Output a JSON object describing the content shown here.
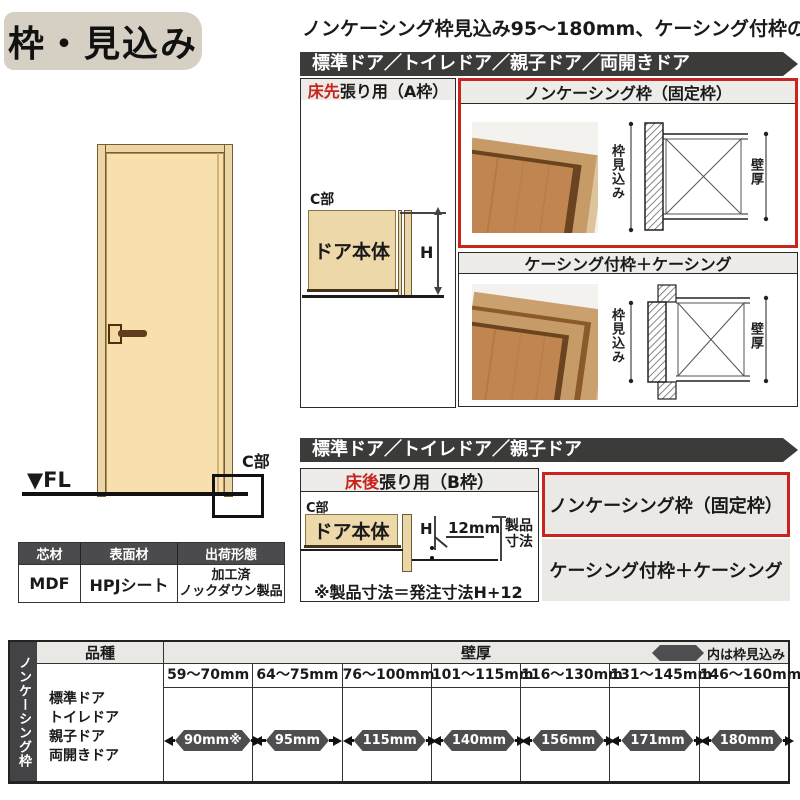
{
  "page": {
    "title": "枠・見込み",
    "heading": "ノンケーシング枠見込み95～180mm、ケーシング付枠の場合"
  },
  "section_a": {
    "door_types_bar": "標準ドア／トイレドア／親子ドア／両開きドア",
    "panel_a": {
      "title_red": "床先",
      "title_rest": "張り用（A枠）",
      "c_part": "C部",
      "door_body": "ドア本体",
      "height_label": "H"
    },
    "noncasing_title": "ノンケーシング枠（固定枠）",
    "casing_title": "ケーシング付枠＋ケーシング",
    "frame_depth_label": "枠見込み",
    "wall_thickness_label": "壁厚"
  },
  "door_figure": {
    "fl_label": "▼FL",
    "c_part_label": "C部"
  },
  "materials_table": {
    "headers": [
      "芯材",
      "表面材",
      "出荷形態"
    ],
    "core": "MDF",
    "surface": "HPJシート",
    "shipping_line1": "加工済",
    "shipping_line2": "ノックダウン製品"
  },
  "section_b": {
    "door_types_bar": "標準ドア／トイレドア／親子ドア",
    "panel_b": {
      "title_red": "床後",
      "title_rest": "張り用（B枠）",
      "c_part": "C部",
      "door_body": "ドア本体",
      "height_label": "H",
      "gap_label": "12mm",
      "product_dim_line1": "製品",
      "product_dim_line2": "寸法",
      "note": "※製品寸法＝発注寸法H+12"
    },
    "noncasing_label": "ノンケーシング枠（固定枠）",
    "casing_label": "ケーシング付枠＋ケーシング"
  },
  "spec_table": {
    "side_label": "ノンケーシング枠",
    "kind_header": "品種",
    "wall_header": "壁厚",
    "legend_label": "内は枠見込み",
    "door_kinds": [
      "標準ドア",
      "トイレドア",
      "親子ドア",
      "両開きドア"
    ],
    "columns": [
      {
        "range": "59～70mm",
        "value": "90mm※"
      },
      {
        "range": "64～75mm",
        "value": "95mm"
      },
      {
        "range": "76～100mm",
        "value": "115mm"
      },
      {
        "range": "101～115mm",
        "value": "140mm"
      },
      {
        "range": "116～130mm",
        "value": "156mm"
      },
      {
        "range": "131～145mm",
        "value": "171mm"
      },
      {
        "range": "146～160mm",
        "value": "180mm"
      }
    ]
  },
  "colors": {
    "accent_red": "#c9251f",
    "bar_dark": "#3b3b39",
    "header_gray": "#edece9",
    "badge_gray": "#4e4e50",
    "title_bg": "#d6cfc3",
    "door_fill": "#f8dfae",
    "frame_tan": "#ead6a6",
    "wood_mid": "#c0854e"
  }
}
